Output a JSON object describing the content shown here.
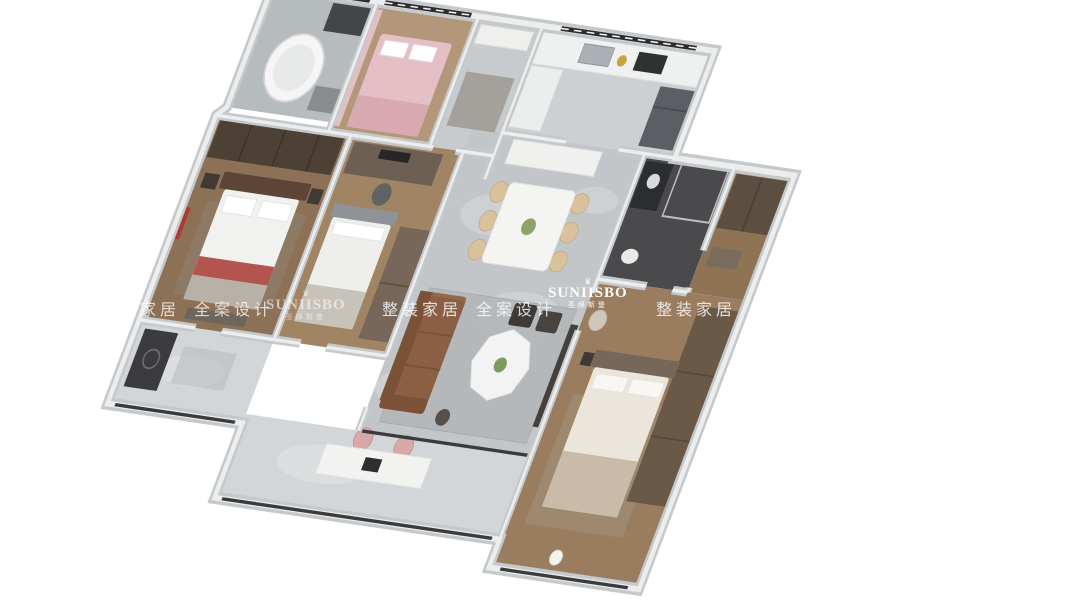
{
  "watermark": {
    "crown_glyph": "♛",
    "brand_en": "SUNIISBO",
    "brand_cn": "圣缔斯堡",
    "tagline": "整装家居 全案设计"
  },
  "palette": {
    "background": "#ffffff",
    "watermark": "#ffffff",
    "wall-core": "#c6c9cb",
    "wall-top": "#eceeee",
    "window-dark": "#2c2d2f",
    "marble-floor": "#c2c6c9",
    "marble-light": "#d3d6d8",
    "wood-floor": "#8d7156",
    "wood-light": "#b2977a",
    "dark-bath": "#4a4a4d",
    "sofa-brown": "#8a5f44",
    "chair-beige": "#d9c29b",
    "bed-white": "#f1f1ef",
    "accent-red": "#a83a31",
    "accent-pink": "#e4bfc6",
    "dark-furniture": "#3e3a38"
  },
  "scene": {
    "description": "3D isometric dollhouse render of a three-bedroom apartment on a white background",
    "rooms": [
      "bathroom-nw",
      "kids-bedroom",
      "entry-hall",
      "kitchen",
      "master-bedroom",
      "study-bedroom",
      "dining-room",
      "living-room",
      "ensuite-bathroom",
      "guest-bedroom",
      "south-balcony",
      "west-corridor"
    ]
  }
}
